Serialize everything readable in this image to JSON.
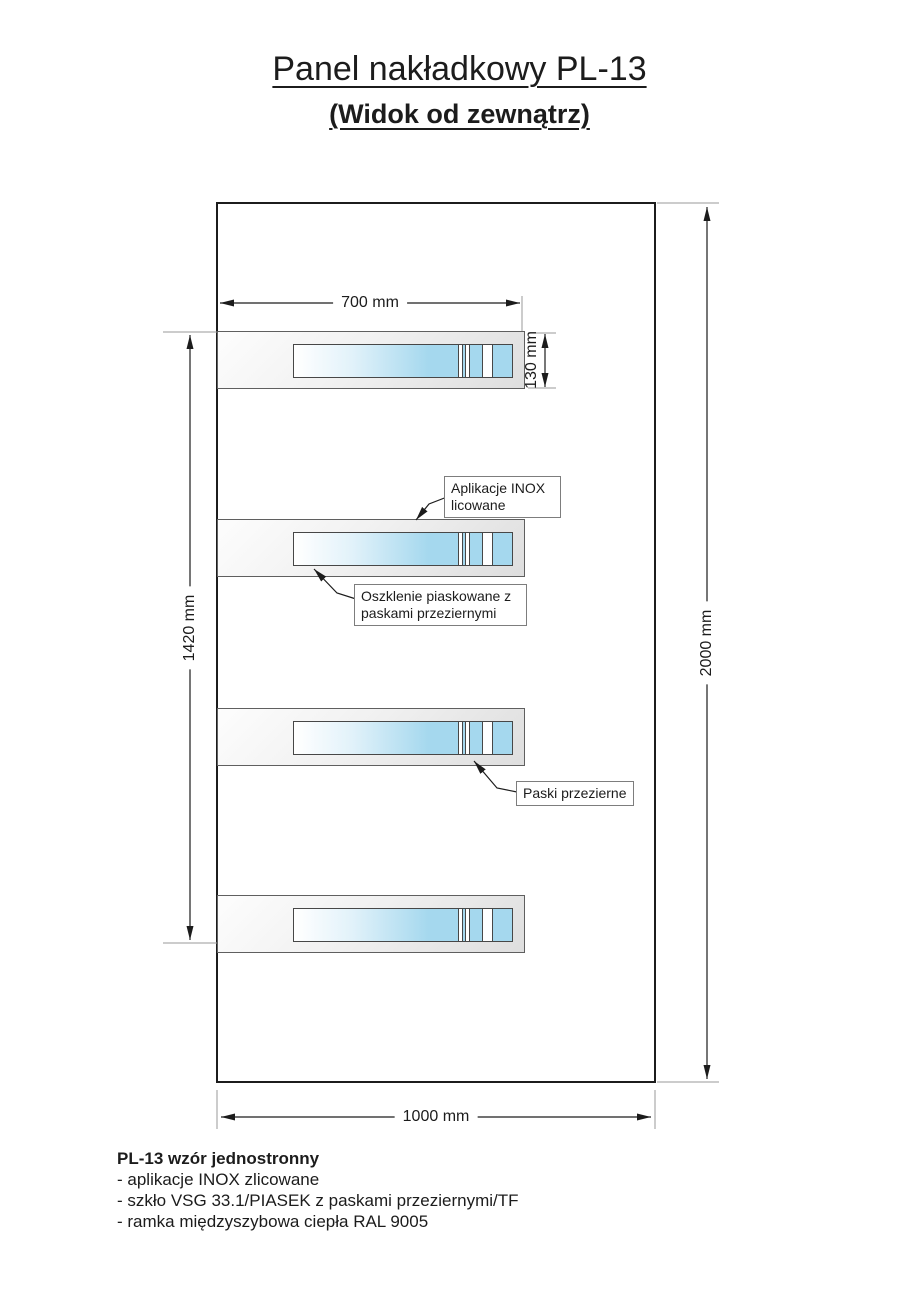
{
  "title": {
    "line1": "Panel nakładkowy PL-13",
    "line2": "(Widok od zewnątrz)"
  },
  "dimensions": {
    "strip_width": "700 mm",
    "strip_height": "130 mm",
    "strips_span": "1420 mm",
    "panel_height": "2000 mm",
    "panel_width": "1000 mm"
  },
  "callouts": {
    "inox": "Aplikacje INOX licowane",
    "glazing": "Oszklenie piaskowane z paskami przeziernymi",
    "stripes": "Paski przezierne"
  },
  "notes": {
    "heading": "PL-13 wzór jednostronny",
    "items": [
      "- aplikacje INOX zlicowane",
      "- szkło VSG 33.1/PIASEK z paskami przeziernymi/TF",
      "- ramka międzyszybowa ciepła RAL 9005"
    ]
  },
  "colors": {
    "glass_blue": "#a5d8ee",
    "band_gray": "#dedede",
    "line": "#1c1c1c"
  }
}
